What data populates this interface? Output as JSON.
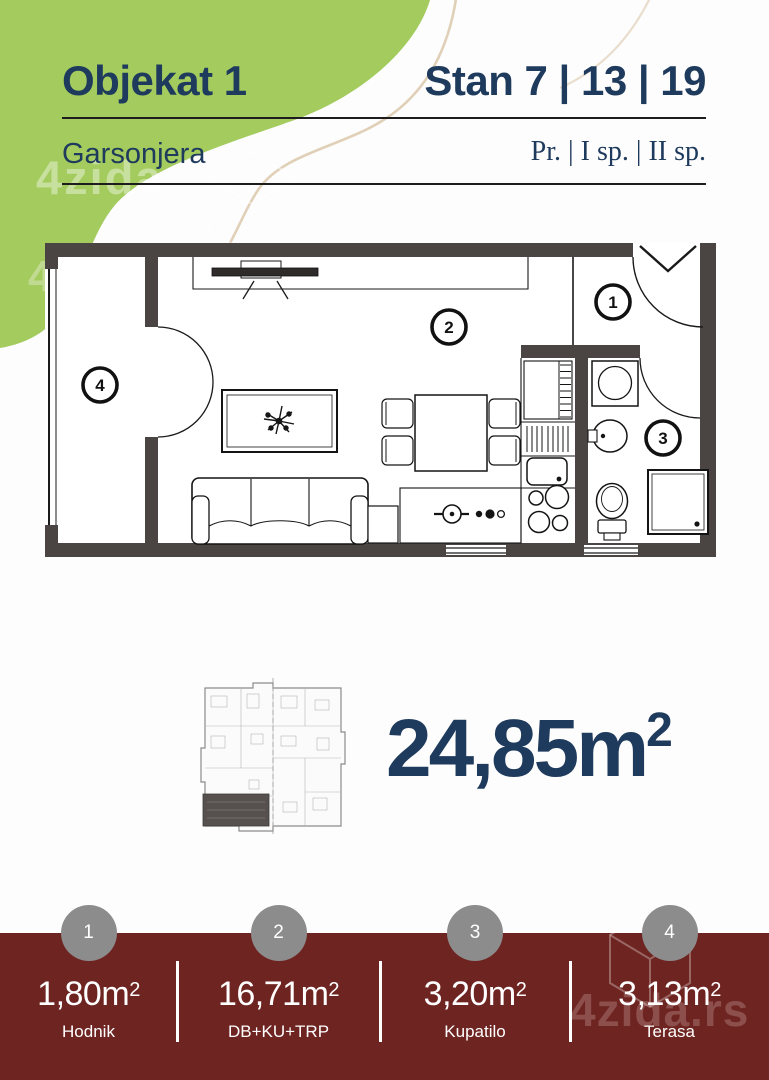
{
  "header": {
    "project": "Objekat 1",
    "unit": "Stan 7 | 13 | 19",
    "apartment_type": "Garsonjera",
    "floors": "Pr. | I sp. | II sp."
  },
  "summary": {
    "total_area": "24,85"
  },
  "units": {
    "area_base": "m",
    "area_sup": "2"
  },
  "footer": {
    "items": [
      {
        "number": "1",
        "area": "1,80",
        "label": "Hodnik"
      },
      {
        "number": "2",
        "area": "16,71",
        "label": "DB+KU+TRP"
      },
      {
        "number": "3",
        "area": "3,20",
        "label": "Kupatilo"
      },
      {
        "number": "4",
        "area": "3,13",
        "label": "Terasa"
      }
    ]
  },
  "watermark": {
    "brand": "4zida",
    "brand_full": "4zida.rs"
  },
  "colors": {
    "navy": "#1e3a5c",
    "green": "#a3cb5e",
    "maroon": "#6e2522",
    "wall": "#4a4543",
    "badge_gray": "#8c8c8c",
    "tan": "#d9c4a6"
  }
}
